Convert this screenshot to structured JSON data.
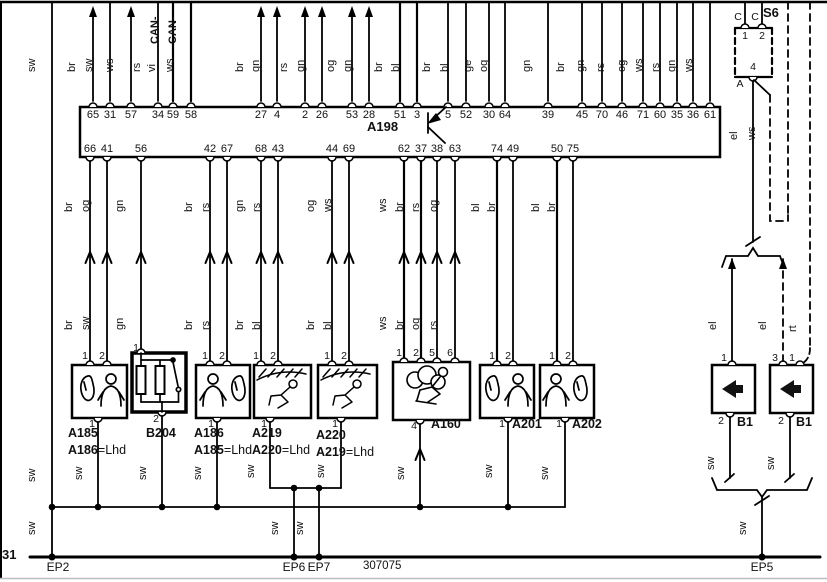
{
  "page": {
    "drawing_number": "307075",
    "ground_terminal": "31"
  },
  "colors": {
    "sw": "sw",
    "el": "el",
    "ws": "ws",
    "rt": "rt"
  },
  "suffix": {
    "lhd": "=Lhd"
  },
  "a198": {
    "name": "A198",
    "can_label": "CAN-",
    "top_pins": [
      {
        "pin": "65",
        "color": "br"
      },
      {
        "pin": "31",
        "color": "sw"
      },
      {
        "pin": "57",
        "color": "ws"
      },
      {
        "pin": "34",
        "color": "rs"
      },
      {
        "pin": "59",
        "color": "vi"
      },
      {
        "pin": "58",
        "color": "ws"
      },
      {
        "pin": "27",
        "color": "br"
      },
      {
        "pin": "4",
        "color": "gn"
      },
      {
        "pin": "2",
        "color": "rs"
      },
      {
        "pin": "26",
        "color": "gn"
      },
      {
        "pin": "53",
        "color": "og"
      },
      {
        "pin": "28",
        "color": "gn"
      },
      {
        "pin": "51",
        "color": "br"
      },
      {
        "pin": "3",
        "color": "bl"
      },
      {
        "pin": "5",
        "color": "br"
      },
      {
        "pin": "52",
        "color": "bl"
      },
      {
        "pin": "30",
        "color": "ge"
      },
      {
        "pin": "64",
        "color": "og"
      },
      {
        "pin": "39",
        "color": "gn"
      },
      {
        "pin": "45",
        "color": "br"
      },
      {
        "pin": "70",
        "color": "gn"
      },
      {
        "pin": "46",
        "color": "rs"
      },
      {
        "pin": "71",
        "color": "og"
      },
      {
        "pin": "60",
        "color": "ws"
      },
      {
        "pin": "35",
        "color": "rs"
      },
      {
        "pin": "36",
        "color": "gn"
      },
      {
        "pin": "61",
        "color": "ws"
      }
    ],
    "bottom_pins": [
      {
        "pin": "66",
        "upper": "br",
        "lower": "br"
      },
      {
        "pin": "41",
        "upper": "og",
        "lower": "sw"
      },
      {
        "pin": "56",
        "upper": "gn",
        "lower": "gn"
      },
      {
        "pin": "42",
        "upper": "br",
        "lower": "br"
      },
      {
        "pin": "67",
        "upper": "rs",
        "lower": "rs"
      },
      {
        "pin": "68",
        "upper": "gn",
        "lower": "br"
      },
      {
        "pin": "43",
        "upper": "rs",
        "lower": "bl"
      },
      {
        "pin": "44",
        "upper": "og",
        "lower": "br"
      },
      {
        "pin": "69",
        "upper": "ws",
        "lower": "bl"
      },
      {
        "pin": "62",
        "upper": "ws",
        "lower": "ws"
      },
      {
        "pin": "37",
        "upper": "br",
        "lower": "br"
      },
      {
        "pin": "38",
        "upper": "rs",
        "lower": "og"
      },
      {
        "pin": "63",
        "upper": "og",
        "lower": "rs"
      },
      {
        "pin": "74",
        "upper": "bl"
      },
      {
        "pin": "49",
        "upper": "br"
      },
      {
        "pin": "50",
        "upper": "bl"
      },
      {
        "pin": "75",
        "upper": "br"
      }
    ]
  },
  "components": [
    {
      "id": "A185",
      "alt": "A186",
      "top_pins": [
        "1",
        "2"
      ],
      "bottom_pin": "1"
    },
    {
      "id": "B204",
      "top_pins": [
        "1"
      ],
      "bottom_pin": "2"
    },
    {
      "id": "A186",
      "alt": "A185",
      "top_pins": [
        "1",
        "2"
      ],
      "bottom_pin": "1"
    },
    {
      "id": "A219",
      "alt": "A220",
      "top_pins": [
        "1",
        "2"
      ],
      "bottom_pin": "1"
    },
    {
      "id": "A220",
      "alt": "A219",
      "top_pins": [
        "1",
        "2"
      ],
      "bottom_pin": "1"
    },
    {
      "id": "A160",
      "top_pins": [
        "1",
        "2",
        "5",
        "6"
      ],
      "bottom_pin": "4"
    },
    {
      "id": "A201",
      "top_pins": [
        "1",
        "2"
      ],
      "bottom_pin": "1"
    },
    {
      "id": "A202",
      "top_pins": [
        "1",
        "2"
      ],
      "bottom_pin": "1"
    }
  ],
  "s6": {
    "name": "S6",
    "c_labels": [
      "C",
      "C"
    ],
    "top_pins": [
      "1",
      "2"
    ],
    "bottom_pin": "4",
    "bottom_pin_letter": "A"
  },
  "b1_left": {
    "name": "B1",
    "top_pins": [
      "1"
    ],
    "bottom_pin": "2"
  },
  "b1_right": {
    "name": "B1",
    "top_pins": [
      "3",
      "1"
    ],
    "bottom_pin": "2"
  },
  "grounds": {
    "ep2": "EP2",
    "ep5": "EP5",
    "ep6": "EP6",
    "ep7": "EP7"
  }
}
